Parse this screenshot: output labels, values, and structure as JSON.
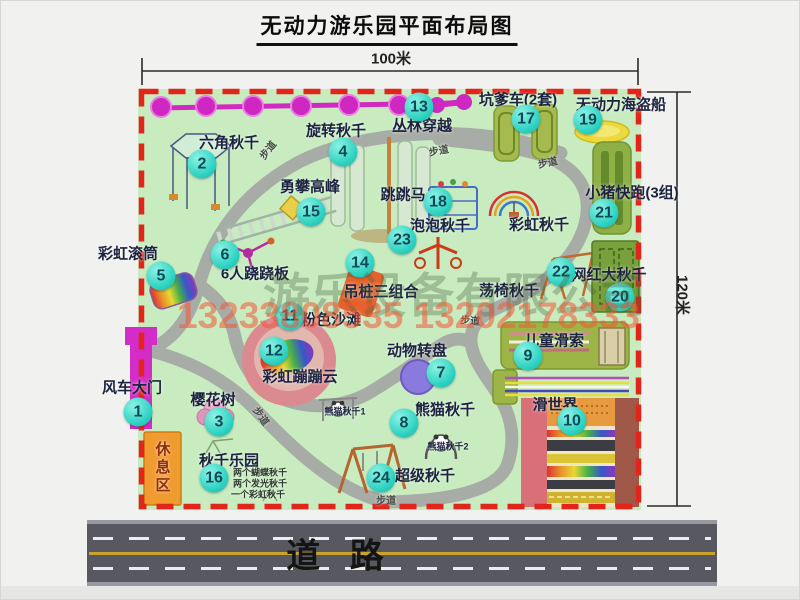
{
  "title": "无动力游乐园平面布局图",
  "dimensions": {
    "width": "100米",
    "height": "120米"
  },
  "road": {
    "label": "道 路"
  },
  "watermark": {
    "company": "游乐设备有限公司",
    "phone": "13233808535 13202178333"
  },
  "colors": {
    "map_green": "#c8ecc0",
    "border_red": "#e2251a",
    "badge_cyan": "#2fd3c3",
    "path_gray": "#a8aca6",
    "chain_magenta": "#d22ac0",
    "gate_magenta": "#d42cc6",
    "rest_area_orange": "#ef9b2f",
    "road_gray": "#585860"
  },
  "map": {
    "attractions": [
      {
        "num": 1,
        "label": "风车大门",
        "bx": 137,
        "by": 411,
        "lx": 131,
        "ly": 387
      },
      {
        "num": 2,
        "label": "六角秋千",
        "bx": 201,
        "by": 163,
        "lx": 228,
        "ly": 142
      },
      {
        "num": 3,
        "label": "樱花树",
        "bx": 218,
        "by": 421,
        "lx": 212,
        "ly": 399
      },
      {
        "num": 4,
        "label": "旋转秋千",
        "bx": 342,
        "by": 151,
        "lx": 335,
        "ly": 130
      },
      {
        "num": 5,
        "label": "彩虹滚筒",
        "bx": 160,
        "by": 275,
        "lx": 127,
        "ly": 253
      },
      {
        "num": 6,
        "label": "6人跷跷板",
        "bx": 224,
        "by": 254,
        "lx": 254,
        "ly": 273
      },
      {
        "num": 7,
        "label": "动物转盘",
        "bx": 440,
        "by": 372,
        "lx": 416,
        "ly": 350
      },
      {
        "num": 8,
        "label": "熊猫秋千",
        "bx": 403,
        "by": 422,
        "lx": 444,
        "ly": 409
      },
      {
        "num": 9,
        "label": "儿童滑索",
        "bx": 527,
        "by": 355,
        "lx": 553,
        "ly": 340
      },
      {
        "num": 10,
        "label": "滑世界",
        "bx": 571,
        "by": 420,
        "lx": 554,
        "ly": 404
      },
      {
        "num": 11,
        "label": "粉色沙滩",
        "bx": 289,
        "by": 315,
        "lx": 330,
        "ly": 319
      },
      {
        "num": 12,
        "label": "彩虹蹦蹦云",
        "bx": 273,
        "by": 350,
        "lx": 299,
        "ly": 376
      },
      {
        "num": 13,
        "label": "丛林穿越",
        "bx": 418,
        "by": 106,
        "lx": 421,
        "ly": 125
      },
      {
        "num": 14,
        "label": "吊桩三组合",
        "bx": 359,
        "by": 262,
        "lx": 380,
        "ly": 291
      },
      {
        "num": 15,
        "label": "勇攀高峰",
        "bx": 310,
        "by": 211,
        "lx": 309,
        "ly": 186
      },
      {
        "num": 16,
        "label": "秋千乐园",
        "bx": 213,
        "by": 477,
        "lx": 228,
        "ly": 460
      },
      {
        "num": 17,
        "label": "坑爹车(2套)",
        "bx": 525,
        "by": 118,
        "lx": 517,
        "ly": 99
      },
      {
        "num": 18,
        "label": "跳跳马",
        "bx": 437,
        "by": 201,
        "lx": 402,
        "ly": 194
      },
      {
        "num": 19,
        "label": "无动力海盗船",
        "bx": 587,
        "by": 119,
        "lx": 620,
        "ly": 104
      },
      {
        "num": 20,
        "label": "网红大秋千",
        "bx": 619,
        "by": 296,
        "lx": 608,
        "ly": 274
      },
      {
        "num": 21,
        "label": "小猪快跑(3组)",
        "bx": 603,
        "by": 212,
        "lx": 631,
        "ly": 192
      },
      {
        "num": 22,
        "label": "荡椅秋千",
        "bx": 560,
        "by": 271,
        "lx": 508,
        "ly": 290
      },
      {
        "num": 23,
        "label": "泡泡秋千",
        "bx": 401,
        "by": 239,
        "lx": 439,
        "ly": 225
      },
      {
        "num": 24,
        "label": "超级秋千",
        "bx": 380,
        "by": 477,
        "lx": 424,
        "ly": 475
      }
    ],
    "labels": [
      {
        "name": "rainbow-swing-label",
        "text": "彩虹秋千",
        "x": 538,
        "y": 224
      },
      {
        "name": "panda-swing-1-label",
        "text": "熊猫秋千1",
        "x": 344,
        "y": 411,
        "size": 9
      },
      {
        "name": "panda-swing-2-label",
        "text": "熊猫秋千2",
        "x": 447,
        "y": 446,
        "size": 9
      },
      {
        "name": "swing-park-note-1",
        "text": "两个蝴蝶秋千",
        "x": 259,
        "y": 472,
        "size": 9,
        "color": "#2e3a2e"
      },
      {
        "name": "swing-park-note-2",
        "text": "两个发光秋千",
        "x": 259,
        "y": 483,
        "size": 9,
        "color": "#2e3a2e"
      },
      {
        "name": "swing-park-note-3",
        "text": "一个彩虹秋千",
        "x": 257,
        "y": 494,
        "size": 9,
        "color": "#2e3a2e"
      },
      {
        "name": "rest-area-label",
        "text": "休息区",
        "x": 161,
        "y": 467,
        "size": 15,
        "vertical": true,
        "color": "#932d0c"
      },
      {
        "name": "footpath-label",
        "text": "步道",
        "x": 268,
        "y": 150,
        "size": 10,
        "rot": -52,
        "color": "#474c45"
      },
      {
        "name": "footpath-label",
        "text": "步道",
        "x": 438,
        "y": 151,
        "size": 10,
        "rot": -10,
        "color": "#474c45"
      },
      {
        "name": "footpath-label",
        "text": "步道",
        "x": 547,
        "y": 163,
        "size": 10,
        "rot": -12,
        "color": "#474c45"
      },
      {
        "name": "footpath-label",
        "text": "步道",
        "x": 469,
        "y": 321,
        "size": 10,
        "rot": 5,
        "color": "#474c45"
      },
      {
        "name": "footpath-label",
        "text": "步道",
        "x": 385,
        "y": 501,
        "size": 10,
        "color": "#474c45"
      },
      {
        "name": "footpath-label",
        "text": "步道",
        "x": 259,
        "y": 416,
        "size": 10,
        "rot": 55,
        "color": "#474c45"
      }
    ]
  }
}
